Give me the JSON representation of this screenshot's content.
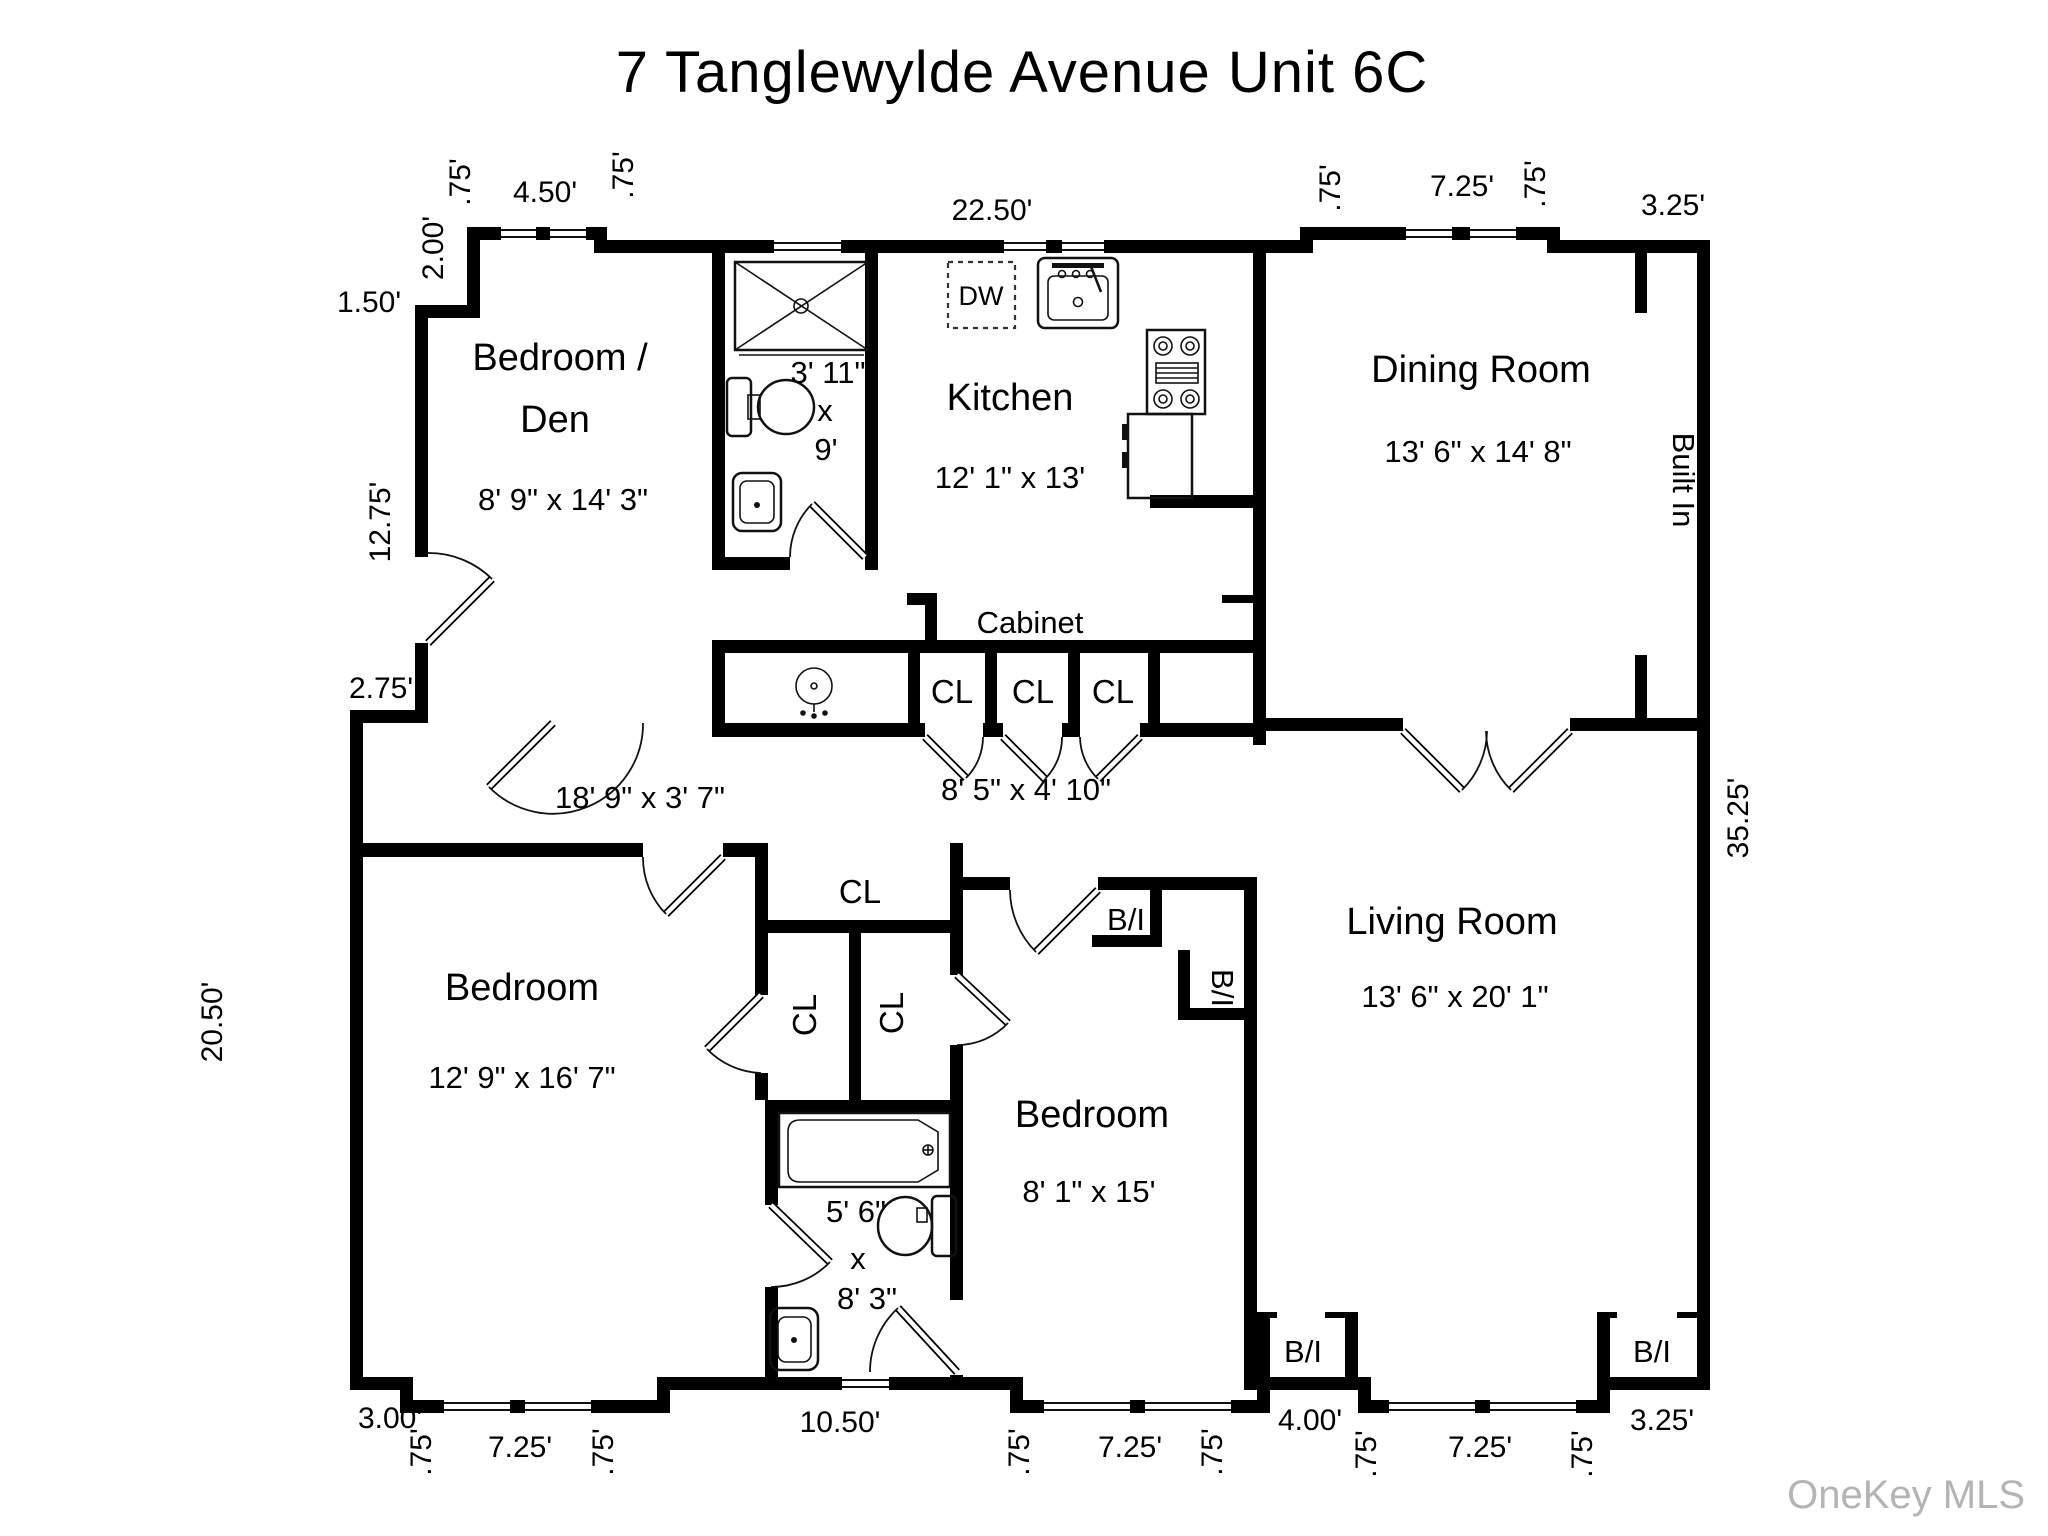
{
  "title": "7 Tanglewylde Avenue Unit 6C",
  "watermark": "OneKey MLS",
  "rooms": {
    "bedroom_den": {
      "name1": "Bedroom /",
      "name2": "Den",
      "dims": "8' 9\" x 14' 3\""
    },
    "kitchen": {
      "name": "Kitchen",
      "dims": "12' 1\" x 13'"
    },
    "dining_room": {
      "name": "Dining Room",
      "dims": "13' 6\" x 14' 8\""
    },
    "living_room": {
      "name": "Living Room",
      "dims": "13' 6\" x 20' 1\""
    },
    "bedroom_left": {
      "name": "Bedroom",
      "dims": "12' 9\" x 16' 7\""
    },
    "bedroom_middle": {
      "name": "Bedroom",
      "dims": "8' 1\" x 15'"
    },
    "bath_upper": {
      "width": "3' 11\"",
      "sep": "x",
      "length": "9'"
    },
    "bath_lower": {
      "width": "5' 6\"",
      "sep": "x",
      "length": "8' 3\""
    },
    "hallway": {
      "dims": "18' 9\" x 3' 7\""
    },
    "foyer": {
      "dims": "8' 5\" x 4' 10\""
    }
  },
  "labels": {
    "cabinet": "Cabinet",
    "closet": "CL",
    "built_in_abbr": "B/I",
    "built_in": "Built In",
    "dishwasher": "DW"
  },
  "dims": {
    "d075": ".75'",
    "d450": "4.50'",
    "d200": "2.00'",
    "d150": "1.50'",
    "d2250": "22.50'",
    "d725": "7.25'",
    "d325": "3.25'",
    "d1275": "12.75'",
    "d275": "2.75'",
    "d2050": "20.50'",
    "d3525": "35.25'",
    "d300": "3.00'",
    "d1050": "10.50'",
    "d400": "4.00'"
  }
}
